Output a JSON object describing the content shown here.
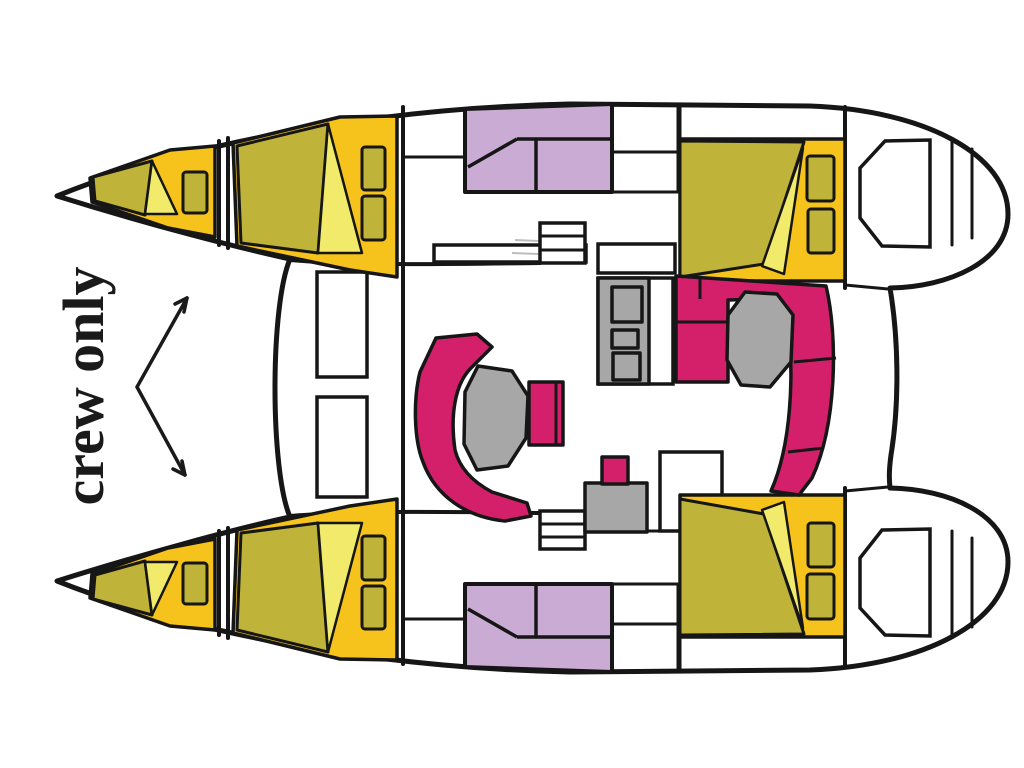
{
  "annotation": {
    "label": "crew only"
  },
  "palette": {
    "outline": "#161616",
    "hull_fill": "#ffffff",
    "bed_frame": "#f6c31d",
    "mattress": "#bfb33a",
    "blanket_fold": "#f1ea6a",
    "upholstery_pink": "#d4206b",
    "table_gray": "#a7a7a7",
    "head_lavender": "#c9abd3",
    "annotation_ink": "#1a1a1a"
  }
}
